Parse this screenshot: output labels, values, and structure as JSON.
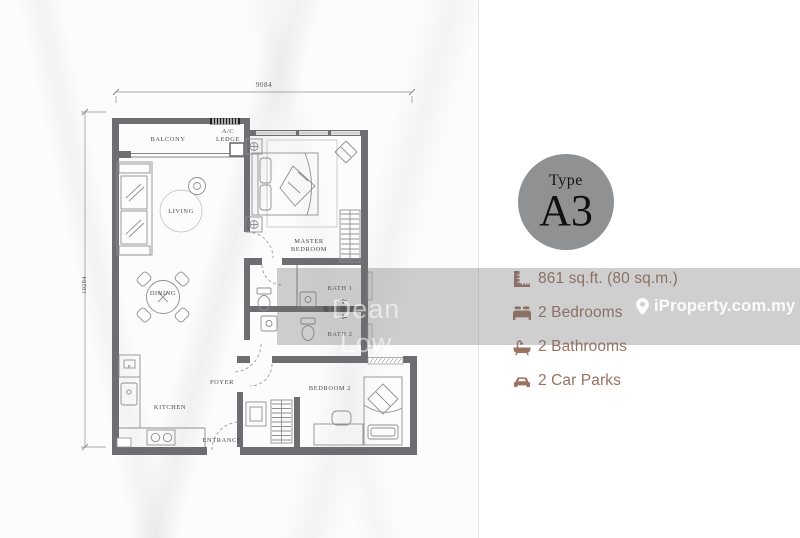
{
  "colors": {
    "wall_gray": "#6d6d72",
    "accent_brown": "#9a7262",
    "badge_gray": "#8f9193",
    "watermark_band": "rgba(110,110,110,0.33)"
  },
  "plan": {
    "dim_width": "9084",
    "dim_height": "10284",
    "rooms": {
      "balcony": "BALCONY",
      "ac_ledge_1": "A/C",
      "ac_ledge_2": "LEDGE",
      "living": "LIVING",
      "dining": "DINING",
      "master_1": "MASTER",
      "master_2": "BEDROOM",
      "bath1": "BATH 1",
      "bath2": "BATH 2",
      "foyer": "FOYER",
      "kitchen": "KITCHEN",
      "entrance": "ENTRANCE",
      "bedroom2": "BEDROOM 2",
      "fridge": "F"
    }
  },
  "badge": {
    "label": "Type",
    "code": "A3"
  },
  "details": {
    "area": "861 sq.ft. (80 sq.m.)",
    "bedrooms": "2 Bedrooms",
    "bathrooms": "2 Bathrooms",
    "carparks": "2 Car Parks"
  },
  "watermarks": {
    "agent": "Dean Low",
    "portal": "iProperty.com.my"
  }
}
